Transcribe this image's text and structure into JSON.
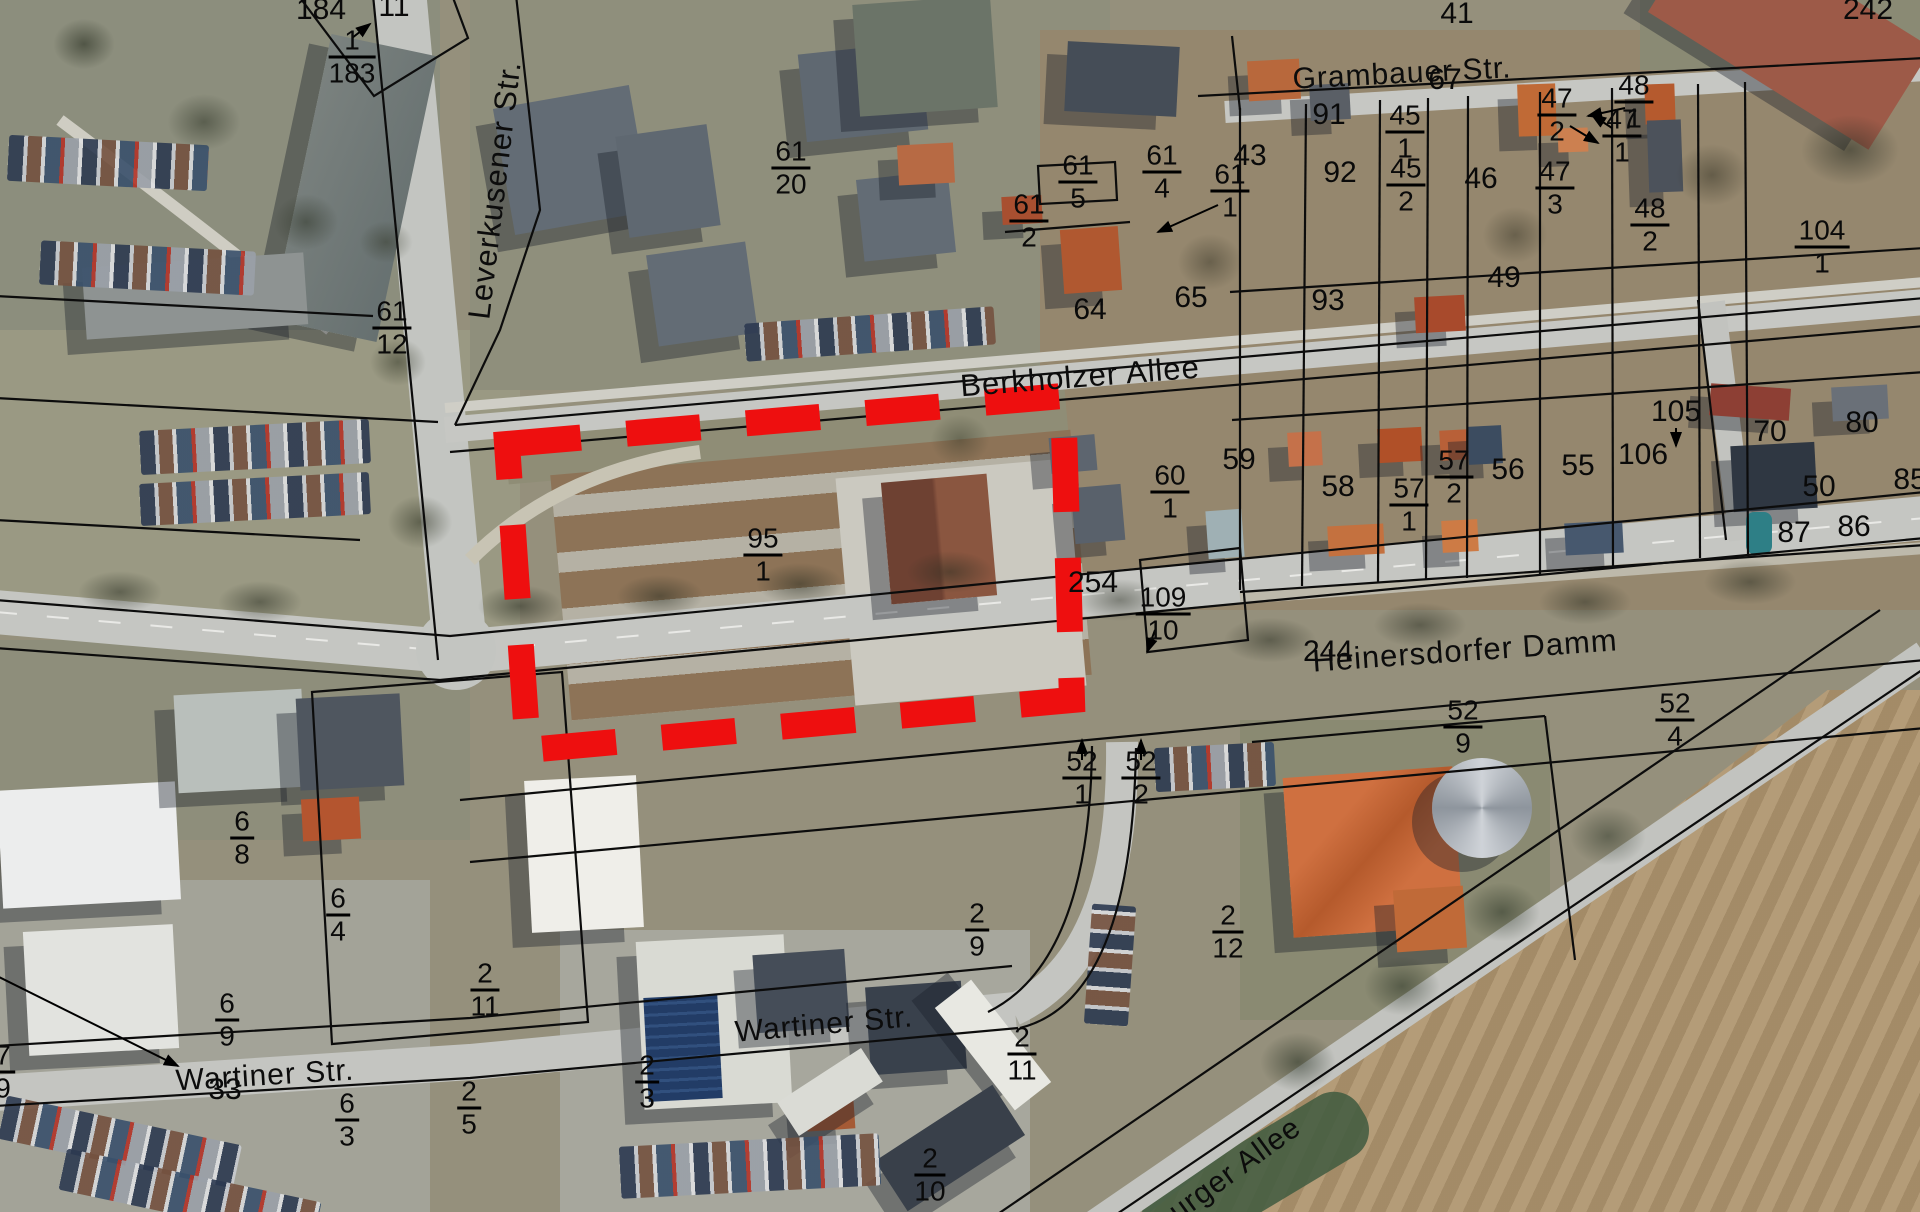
{
  "map": {
    "type": "aerial-cadastral-map",
    "ground_color": "#95907c",
    "road_color": "#c5c6c2",
    "cadastral_line_color": "#0c0c0c"
  },
  "highlight": {
    "description": "red dashed parcel outline",
    "color": "#ee0f0f",
    "stroke_width": 26,
    "dash": "74 46",
    "points": "507,444 1063,396 1072,700 528,750"
  },
  "streets": [
    {
      "name": "Leverkusener Str.",
      "x": 495,
      "y": 190,
      "rot": -83,
      "size": 31
    },
    {
      "name": "Berkholzer Allee",
      "x": 1080,
      "y": 377,
      "rot": -4.5,
      "size": 31
    },
    {
      "name": "Grambauer Str.",
      "x": 1402,
      "y": 74,
      "rot": -3,
      "size": 30
    },
    {
      "name": "Heinersdorfer Damm",
      "x": 1465,
      "y": 651,
      "rot": -4,
      "size": 31
    },
    {
      "name": "Wartiner Str.",
      "x": 265,
      "y": 1076,
      "rot": -3.5,
      "size": 30
    },
    {
      "name": "Wartiner Str.",
      "x": 824,
      "y": 1025,
      "rot": -5,
      "size": 30
    },
    {
      "name": "burger Allee",
      "x": 1228,
      "y": 1175,
      "rot": -36,
      "size": 30
    }
  ],
  "parcels": [
    {
      "n": "184",
      "x": 321,
      "y": 10
    },
    {
      "n": "11",
      "x": 394,
      "y": 7
    },
    {
      "n": "1",
      "d": "183",
      "x": 352,
      "y": 57
    },
    {
      "n": "61",
      "d": "12",
      "x": 392,
      "y": 328
    },
    {
      "n": "61",
      "d": "20",
      "x": 791,
      "y": 168
    },
    {
      "n": "61",
      "d": "5",
      "x": 1078,
      "y": 182
    },
    {
      "n": "61",
      "d": "2",
      "x": 1029,
      "y": 221
    },
    {
      "n": "61",
      "d": "4",
      "x": 1162,
      "y": 172
    },
    {
      "n": "61",
      "d": "1",
      "x": 1230,
      "y": 191
    },
    {
      "n": "91",
      "x": 1329,
      "y": 115
    },
    {
      "n": "92",
      "x": 1340,
      "y": 173
    },
    {
      "n": "43",
      "x": 1250,
      "y": 156
    },
    {
      "n": "45",
      "d": "1",
      "x": 1405,
      "y": 132
    },
    {
      "n": "45",
      "d": "2",
      "x": 1406,
      "y": 185
    },
    {
      "n": "46",
      "x": 1481,
      "y": 179
    },
    {
      "n": "67",
      "x": 1445,
      "y": 80
    },
    {
      "n": "47",
      "d": "2",
      "x": 1557,
      "y": 115
    },
    {
      "n": "47",
      "d": "1",
      "x": 1622,
      "y": 136
    },
    {
      "n": "47",
      "d": "3",
      "x": 1555,
      "y": 188
    },
    {
      "n": "48",
      "d": "1",
      "x": 1634,
      "y": 102
    },
    {
      "n": "48",
      "d": "2",
      "x": 1650,
      "y": 225
    },
    {
      "n": "41",
      "x": 1457,
      "y": 14
    },
    {
      "n": "242",
      "x": 1868,
      "y": 10
    },
    {
      "n": "104",
      "d": "1",
      "x": 1822,
      "y": 247
    },
    {
      "n": "64",
      "x": 1090,
      "y": 310
    },
    {
      "n": "65",
      "x": 1191,
      "y": 298
    },
    {
      "n": "93",
      "x": 1328,
      "y": 301
    },
    {
      "n": "49",
      "x": 1504,
      "y": 278
    },
    {
      "n": "95",
      "d": "1",
      "x": 763,
      "y": 555
    },
    {
      "n": "254",
      "x": 1093,
      "y": 583
    },
    {
      "n": "60",
      "d": "1",
      "x": 1170,
      "y": 492
    },
    {
      "n": "59",
      "x": 1239,
      "y": 460
    },
    {
      "n": "58",
      "x": 1338,
      "y": 487
    },
    {
      "n": "57",
      "d": "2",
      "x": 1454,
      "y": 477
    },
    {
      "n": "57",
      "d": "1",
      "x": 1409,
      "y": 505
    },
    {
      "n": "56",
      "x": 1508,
      "y": 470
    },
    {
      "n": "55",
      "x": 1578,
      "y": 466
    },
    {
      "n": "105",
      "x": 1676,
      "y": 412
    },
    {
      "n": "106",
      "x": 1643,
      "y": 455
    },
    {
      "n": "70",
      "x": 1770,
      "y": 432
    },
    {
      "n": "80",
      "x": 1862,
      "y": 423
    },
    {
      "n": "50",
      "x": 1819,
      "y": 487
    },
    {
      "n": "85",
      "x": 1910,
      "y": 480
    },
    {
      "n": "86",
      "x": 1854,
      "y": 527
    },
    {
      "n": "87",
      "x": 1794,
      "y": 533
    },
    {
      "n": "109",
      "d": "10",
      "x": 1163,
      "y": 614
    },
    {
      "n": "244",
      "x": 1328,
      "y": 652
    },
    {
      "n": "52",
      "d": "1",
      "x": 1082,
      "y": 778
    },
    {
      "n": "52",
      "d": "2",
      "x": 1141,
      "y": 778
    },
    {
      "n": "52",
      "d": "9",
      "x": 1463,
      "y": 727
    },
    {
      "n": "52",
      "d": "4",
      "x": 1675,
      "y": 720
    },
    {
      "n": "6",
      "d": "8",
      "x": 242,
      "y": 838
    },
    {
      "n": "6",
      "d": "4",
      "x": 338,
      "y": 915
    },
    {
      "n": "6",
      "d": "9",
      "x": 227,
      "y": 1020
    },
    {
      "n": "2",
      "d": "11",
      "x": 485,
      "y": 990
    },
    {
      "n": "7",
      "d": "9",
      "x": 3,
      "y": 1072
    },
    {
      "n": "33",
      "x": 225,
      "y": 1090
    },
    {
      "n": "2",
      "d": "3",
      "x": 647,
      "y": 1082
    },
    {
      "n": "6",
      "d": "3",
      "x": 347,
      "y": 1120
    },
    {
      "n": "2",
      "d": "5",
      "x": 469,
      "y": 1108
    },
    {
      "n": "2",
      "d": "9",
      "x": 977,
      "y": 930
    },
    {
      "n": "2",
      "d": "12",
      "x": 1228,
      "y": 932
    },
    {
      "n": "2",
      "d": "11",
      "x": 1022,
      "y": 1054
    },
    {
      "n": "2",
      "d": "10",
      "x": 930,
      "y": 1175
    }
  ]
}
